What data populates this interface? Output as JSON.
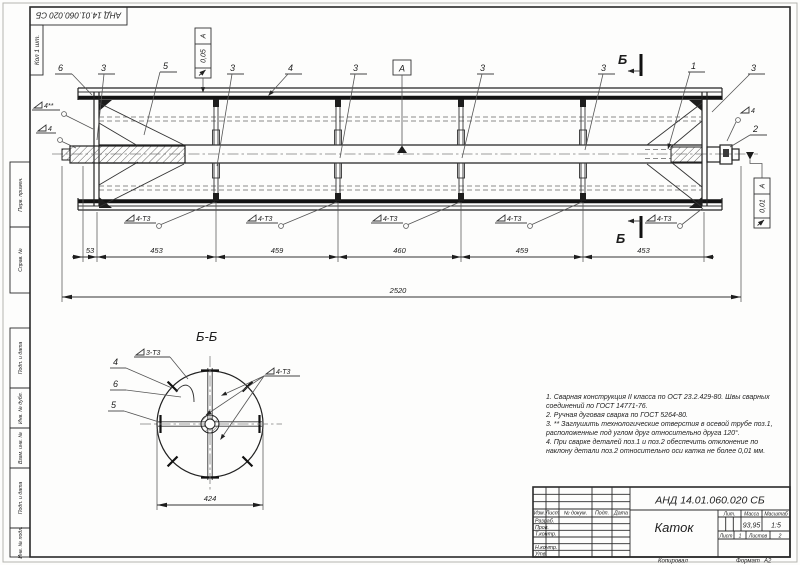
{
  "sheet": {
    "corner_doc_number": "АНД 14.01.060.020 СБ",
    "corner_qty": "Кол 1 шт.",
    "margin_labels": [
      "Перв. примен.",
      "Справ. №",
      "Подп. и дата",
      "Инв. № дубл.",
      "Взам. инв. №",
      "Подп. и дата",
      "Инв. № подл."
    ],
    "copy": "Копировал",
    "format_label": "Формат",
    "format_value": "А2"
  },
  "main_view": {
    "callouts": {
      "c1": "1",
      "c2": "2",
      "c3": "3",
      "c4": "4",
      "c5": "5",
      "c6": "6"
    },
    "datum": "А",
    "section_letter": "Б",
    "fcf_left": {
      "value": "0,05",
      "datum": "А"
    },
    "fcf_right": {
      "value": "0,01",
      "datum": "А"
    },
    "weld_4_star": "4**",
    "weld_4": "4",
    "weld_4t3": "4-Т3",
    "dims": {
      "chain": [
        "53",
        "453",
        "459",
        "460",
        "459",
        "453"
      ],
      "overall": "2520"
    }
  },
  "section_view": {
    "title": "Б-Б",
    "c4": "4",
    "c6": "6",
    "c5": "5",
    "weld_3t3": "3-Т3",
    "weld_4t3": "4-Т3",
    "dim": "424"
  },
  "notes": [
    "1. Сварная конструкция II класса по ОСТ 23.2.429-80. Швы сварных",
    "соединений по ГОСТ 14771-76.",
    "2. Ручная дуговая сварка по ГОСТ 5264-80.",
    "3. ** Заглушить технологические отверстия в осевой трубе поз.1,",
    "расположенные под углом друг относительно друга 120°.",
    "4. При сварке деталей поз.1 и поз.2 обеспечить отклонение по",
    "наклону детали поз.2 относительно оси катка не более 0,01 мм."
  ],
  "title_block": {
    "doc_number": "АНД 14.01.060.020 СБ",
    "name": "Каток",
    "cols": [
      "Изм.",
      "Лист",
      "№ докум.",
      "Подп.",
      "Дата"
    ],
    "rows": [
      "Разраб.",
      "Пров.",
      "Т.контр.",
      "Н.контр.",
      "Утв."
    ],
    "lit": "Лит.",
    "mass_label": "Масса",
    "scale_label": "Масштаб",
    "mass": "93,95",
    "scale": "1:5",
    "sheet_label": "Лист",
    "sheet_value": "1",
    "sheets_label": "Листов",
    "sheets_value": "2"
  }
}
